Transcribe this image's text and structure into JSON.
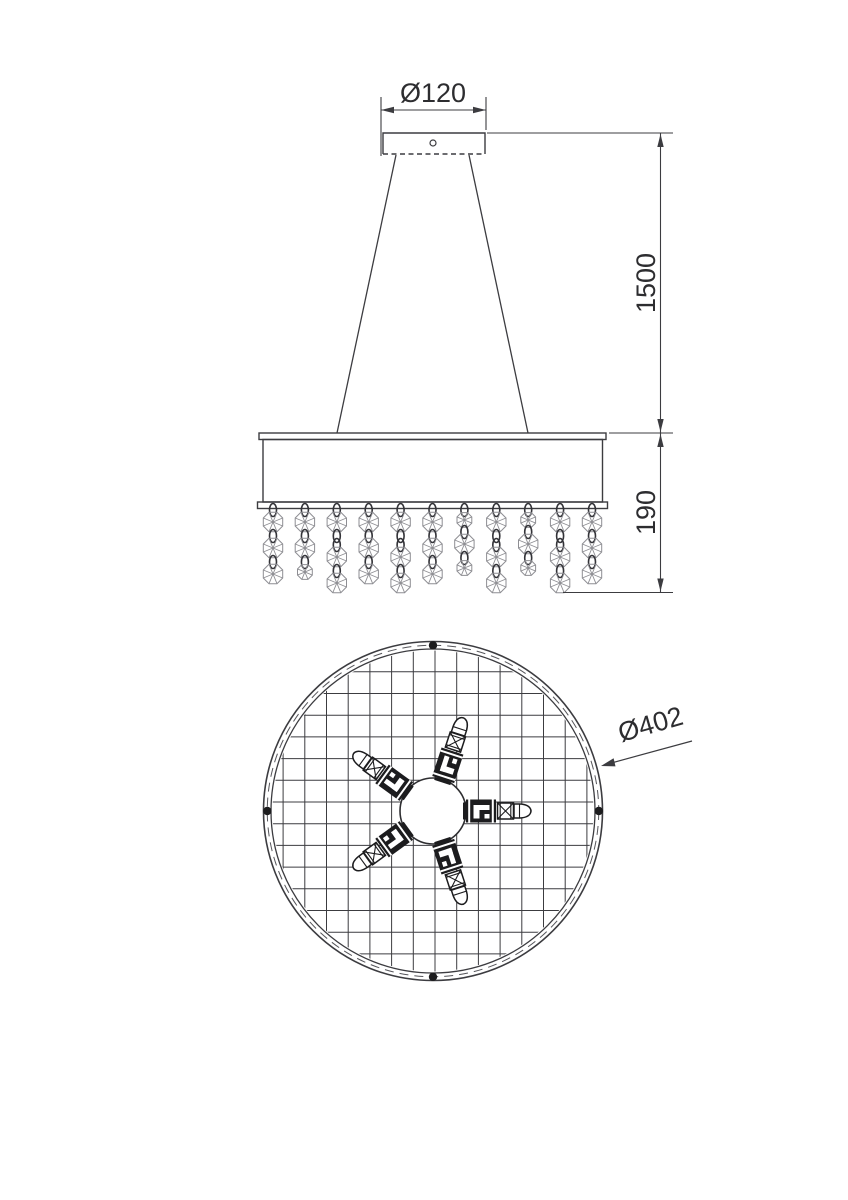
{
  "drawing": {
    "subject": "pendant-chandelier-technical-drawing",
    "dimensions": {
      "canopy_diameter": "Ø120",
      "suspension_height": "1500",
      "shade_height": "190",
      "shade_diameter": "Ø402"
    },
    "colors": {
      "line": "#3c3c40",
      "dark_fill": "#1c1c1e",
      "crystal_line": "#8e8e93",
      "link_line": "#333338",
      "background": "#ffffff",
      "text": "#2d2d30"
    },
    "side_view": {
      "strand_xs": [
        273.0,
        304.9,
        336.8,
        368.7,
        400.6,
        432.5,
        464.4,
        496.3,
        528.2,
        560.1,
        592.0
      ],
      "strand_sequences": [
        [
          "o",
          "O",
          "o",
          "O",
          "o",
          "O"
        ],
        [
          "o",
          "O",
          "o",
          "O",
          "o",
          "s"
        ],
        [
          "o",
          "O",
          "o",
          "o",
          "O",
          "o",
          "O"
        ],
        [
          "o",
          "O",
          "o",
          "O",
          "o",
          "O"
        ],
        [
          "o",
          "O",
          "o",
          "o",
          "O",
          "o",
          "O"
        ],
        [
          "o",
          "O",
          "o",
          "O",
          "o",
          "O"
        ],
        [
          "o",
          "s",
          "o",
          "O",
          "o",
          "s"
        ],
        [
          "o",
          "O",
          "o",
          "o",
          "O",
          "o",
          "O"
        ],
        [
          "o",
          "s",
          "o",
          "O",
          "o",
          "s"
        ],
        [
          "o",
          "O",
          "o",
          "o",
          "O",
          "o",
          "O"
        ],
        [
          "o",
          "O",
          "o",
          "O",
          "o",
          "O"
        ]
      ],
      "strand_top_y": 504
    },
    "bottom_view": {
      "center": {
        "x": 433,
        "y": 811
      },
      "outer_radius": 169.5,
      "inner_radius": 162,
      "dashed_radius": 165.75,
      "grid_spacing": 21.7,
      "grid_clip_radius": 160.5,
      "mount_dot_angles_deg": [
        90,
        180,
        270,
        0
      ],
      "lamp_count": 5,
      "lamp_rotations_deg": [
        0,
        -72,
        -144,
        -216,
        -288
      ]
    }
  }
}
